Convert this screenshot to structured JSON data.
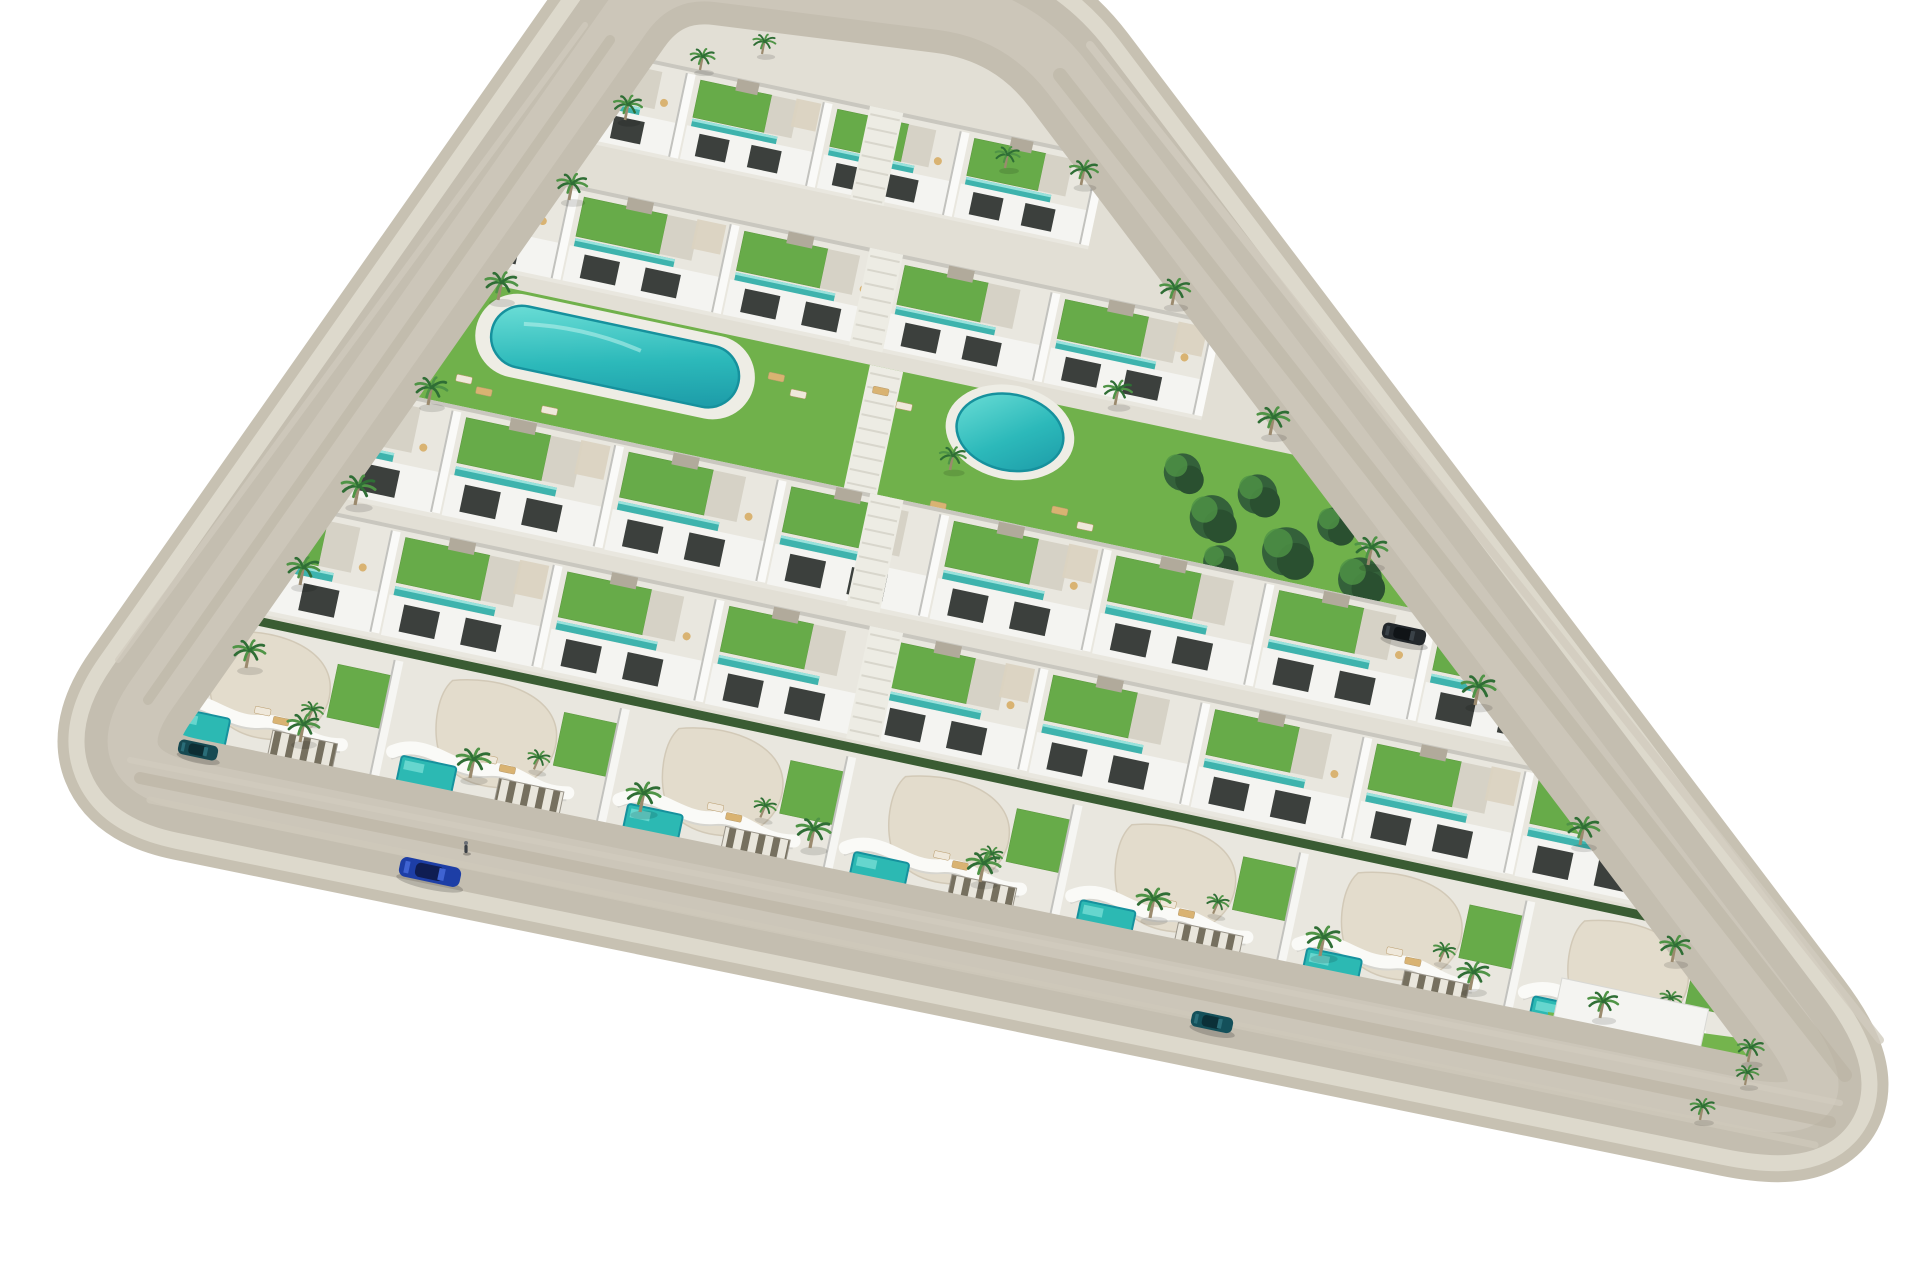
{
  "scene": {
    "description": "Aerial 3D architectural render of a triangular residential resort development with white terraced apartments, curved-roof villas, roof gardens, turquoise pools, palm trees, and a perimeter road on a white background",
    "width": 1920,
    "height": 1280,
    "background": "#ffffff"
  },
  "palette": {
    "gravel": "#c7c1b2",
    "curb": "#ddd9cc",
    "road": "#c4beb0",
    "road_center": "#cdc7ba",
    "sidewalk": "#e2dfd5",
    "row_base": "#e9e7df",
    "grass": "#74b44d",
    "grass_dark": "#5d9a3f",
    "roof_garden": "#67ab49",
    "teal": "#3eb3ad",
    "teal_light": "#98e2dc",
    "pool_rim": "#16919d",
    "building_white": "#f4f4f1",
    "divider_shadow": "#c2c2be",
    "opening_dark": "#3c403d",
    "terrace_gray": "#d6d2c6",
    "stair_gray": "#b1aa9b",
    "pergola": "#dbd3c1",
    "cream_roof": "#e3dccc",
    "cream_edge": "#d2c9b7",
    "hedge": "#3a5c33",
    "palm_green_1": "#2f6e35",
    "palm_green_2": "#4f9446",
    "trunk": "#9b8a6e",
    "tree_dark": "#34613a",
    "tree_darker": "#2a5030",
    "lounger_tan": "#d9b372",
    "lounger_white": "#efe8da",
    "walkway": "#edece4",
    "walkway_step": "#d8d6cc",
    "deck": "#eeede5"
  },
  "roads": {
    "polygon": [
      [
        660,
        -30
      ],
      [
        1020,
        15
      ],
      [
        1862,
        1128
      ],
      [
        100,
        768
      ]
    ],
    "corner_radii": [
      60,
      80,
      130,
      90
    ],
    "gravel_width": 150,
    "curb_width": 128,
    "road_width": 96,
    "center_width": 50,
    "streaks": [
      {
        "x1": 140,
        "y1": 778,
        "x2": 1830,
        "y2": 1122,
        "w": 12,
        "c": "#b8b09f",
        "o": 0.5
      },
      {
        "x1": 150,
        "y1": 800,
        "x2": 1815,
        "y2": 1145,
        "w": 7,
        "c": "#cfc9bb",
        "o": 0.8
      },
      {
        "x1": 130,
        "y1": 760,
        "x2": 1840,
        "y2": 1103,
        "w": 6,
        "c": "#d2ccbf",
        "o": 0.7
      },
      {
        "x1": 1060,
        "y1": 75,
        "x2": 1845,
        "y2": 1075,
        "w": 14,
        "c": "#b8b09f",
        "o": 0.45
      },
      {
        "x1": 1090,
        "y1": 45,
        "x2": 1880,
        "y2": 1040,
        "w": 8,
        "c": "#d2ccbf",
        "o": 0.8
      },
      {
        "x1": 610,
        "y1": 40,
        "x2": 148,
        "y2": 700,
        "w": 10,
        "c": "#b8b09f",
        "o": 0.45
      },
      {
        "x1": 585,
        "y1": 25,
        "x2": 118,
        "y2": 660,
        "w": 6,
        "c": "#d2ccbf",
        "o": 0.7
      }
    ]
  },
  "row_angle_deg": 12,
  "rows": [
    {
      "name": "apartment-row-1",
      "type": "apartments",
      "x": 560,
      "y": 40,
      "len": 560,
      "depth": 95,
      "units": 4,
      "walkway_lx": 317
    },
    {
      "name": "apartment-row-2",
      "type": "apartments",
      "x": 420,
      "y": 152,
      "len": 820,
      "depth": 100,
      "units": 5,
      "walkway_lx": 460
    },
    {
      "name": "garden-pool-band",
      "type": "lawn",
      "x": 330,
      "y": 250,
      "len": 1150,
      "depth": 165,
      "walkway_lx": 552
    },
    {
      "name": "apartment-row-3",
      "type": "apartments",
      "x": 300,
      "y": 372,
      "len": 1330,
      "depth": 115,
      "units": 8,
      "walkway_lx": 583
    },
    {
      "name": "apartment-row-4",
      "type": "apartments",
      "x": 240,
      "y": 492,
      "len": 1490,
      "depth": 115,
      "units": 9,
      "walkway_lx": 644
    },
    {
      "name": "villa-row",
      "type": "villas",
      "x": 180,
      "y": 600,
      "len": 1620,
      "depth": 150,
      "units": 7
    }
  ],
  "lawn_detail": {
    "lagoon_pool": {
      "x": 175,
      "y": 14,
      "w": 252,
      "h": 62
    },
    "round_pool": {
      "cx": 703,
      "cy": 37,
      "rx": 54,
      "ry": 38
    },
    "loungers": [
      [
        150,
        95
      ],
      [
        172,
        103
      ],
      [
        240,
        108
      ],
      [
        455,
        28
      ],
      [
        480,
        40
      ],
      [
        560,
        20
      ],
      [
        586,
        30
      ],
      [
        640,
        120
      ],
      [
        668,
        130
      ],
      [
        760,
        100
      ],
      [
        788,
        110
      ]
    ],
    "trees": [
      [
        880,
        40,
        34
      ],
      [
        918,
        78,
        40
      ],
      [
        958,
        46,
        36
      ],
      [
        998,
        96,
        44
      ],
      [
        1040,
        60,
        32
      ],
      [
        1076,
        108,
        40
      ],
      [
        935,
        120,
        30
      ],
      [
        1060,
        20,
        26
      ]
    ]
  },
  "tip_garden": {
    "slab": {
      "x": 1562,
      "y": 978,
      "w": 150,
      "h": 88,
      "rot": 12
    },
    "lawn": [
      [
        1548,
        1012
      ],
      [
        1768,
        1042
      ],
      [
        1806,
        1118
      ],
      [
        1700,
        1186
      ],
      [
        1552,
        1118
      ]
    ],
    "pool": {
      "x": 1626,
      "y": 1112,
      "w": 72,
      "h": 44,
      "rot": 14
    },
    "hedges": [
      {
        "x": 1556,
        "y": 1186,
        "w": 110,
        "h": 13,
        "rot": 14
      },
      {
        "x": 1676,
        "y": 1206,
        "w": 88,
        "h": 13,
        "rot": 22
      }
    ]
  },
  "palms": [
    [
      625,
      120,
      30
    ],
    [
      569,
      200,
      32
    ],
    [
      498,
      300,
      34
    ],
    [
      428,
      405,
      34
    ],
    [
      355,
      505,
      36
    ],
    [
      300,
      585,
      34
    ],
    [
      246,
      668,
      34
    ],
    [
      300,
      742,
      34
    ],
    [
      470,
      778,
      36
    ],
    [
      640,
      812,
      36
    ],
    [
      810,
      848,
      36
    ],
    [
      980,
      882,
      36
    ],
    [
      1150,
      918,
      36
    ],
    [
      1320,
      956,
      36
    ],
    [
      1470,
      990,
      34
    ],
    [
      1600,
      1018,
      32
    ],
    [
      1081,
      185,
      30
    ],
    [
      1172,
      305,
      32
    ],
    [
      1270,
      435,
      34
    ],
    [
      1368,
      565,
      34
    ],
    [
      1475,
      705,
      36
    ],
    [
      1580,
      845,
      34
    ],
    [
      1672,
      962,
      32
    ],
    [
      1748,
      1062,
      28
    ],
    [
      700,
      70,
      26
    ],
    [
      762,
      54,
      24
    ],
    [
      1005,
      168,
      26
    ],
    [
      1115,
      405,
      30
    ],
    [
      950,
      470,
      28
    ],
    [
      1700,
      1120,
      26
    ],
    [
      1745,
      1085,
      24
    ]
  ],
  "cars": [
    {
      "name": "blue-car-on-road",
      "x": 430,
      "y": 872,
      "rot": 12,
      "w": 62,
      "h": 20,
      "body": "#1d3ea6",
      "roof": "#0f1d52",
      "glass": "#3f63d2"
    },
    {
      "name": "parked-teal-car",
      "x": 1212,
      "y": 1022,
      "rot": 12,
      "w": 42,
      "h": 16,
      "body": "#14505a",
      "roof": "#0b3038",
      "glass": "#2a6d78"
    },
    {
      "name": "parked-dark-car",
      "x": 1404,
      "y": 634,
      "rot": 12,
      "w": 44,
      "h": 16,
      "body": "#23282c",
      "roof": "#101417",
      "glass": "#3a4248"
    },
    {
      "name": "parked-teal-car-2",
      "x": 198,
      "y": 750,
      "rot": 12,
      "w": 40,
      "h": 15,
      "body": "#174a52",
      "roof": "#0c2d33",
      "glass": "#2a6d78"
    }
  ],
  "pedestrian": {
    "x": 466,
    "y": 845
  }
}
